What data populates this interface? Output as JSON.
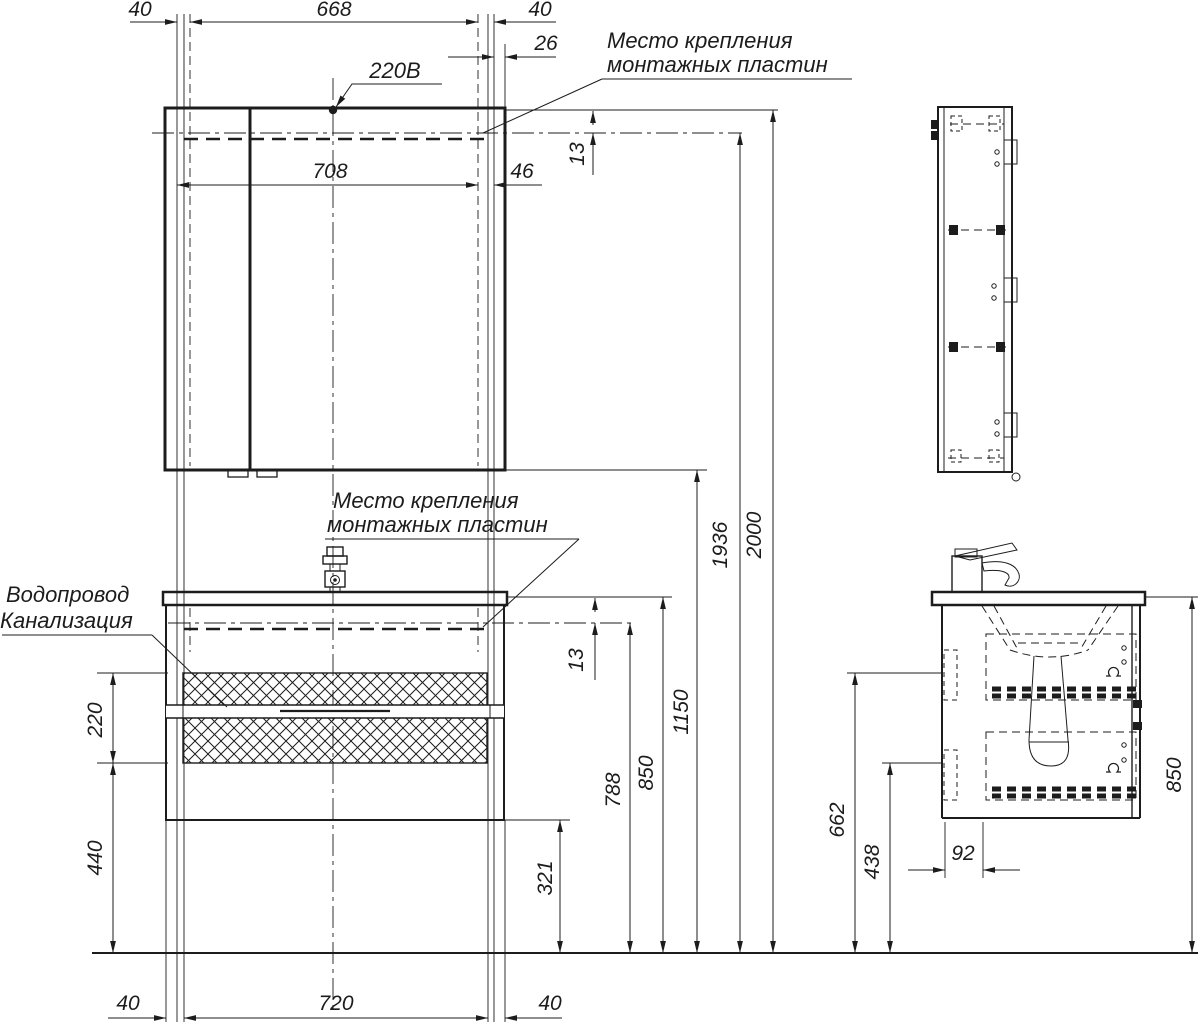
{
  "colors": {
    "line": "#1c1c1c",
    "background": "#ffffff"
  },
  "labels": {
    "power": "220В",
    "mount1": "Место крепления",
    "mount2": "монтажных пластин",
    "water": "Водопровод",
    "sewer": "Канализация"
  },
  "dims": {
    "top_40_left": "40",
    "top_668": "668",
    "top_40_right": "40",
    "top_26": "26",
    "top_708": "708",
    "top_46": "46",
    "top_13": "13",
    "counter_13": "13",
    "h_321": "321",
    "h_788": "788",
    "h_850": "850",
    "h_1150": "1150",
    "h_1936": "1936",
    "h_2000": "2000",
    "left_220": "220",
    "left_440": "440",
    "bottom_40_left": "40",
    "bottom_720": "720",
    "bottom_40_right": "40",
    "side_850": "850",
    "side_662": "662",
    "side_438": "438",
    "side_92": "92"
  }
}
